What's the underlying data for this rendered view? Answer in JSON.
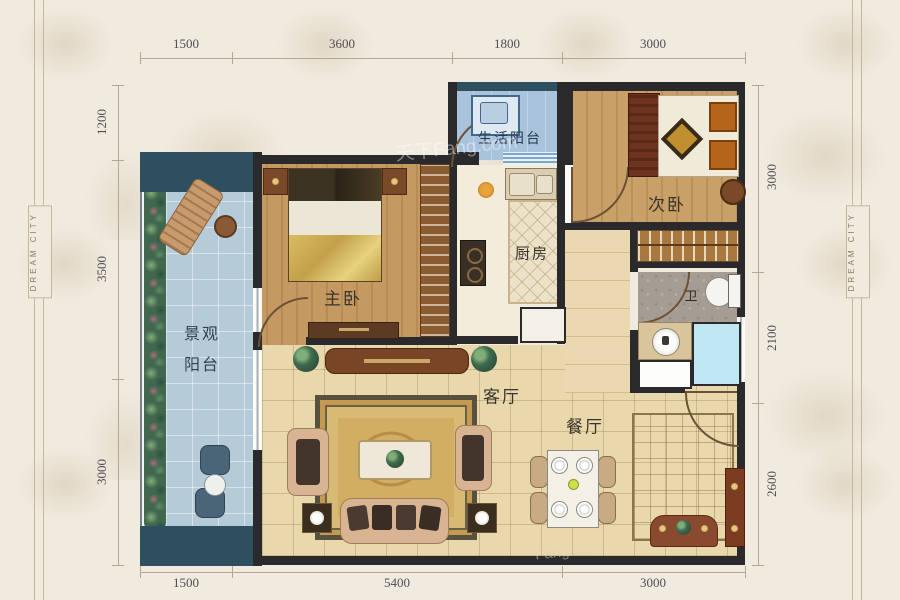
{
  "page": {
    "brand_left": "DREAM CITY",
    "brand_right": "DREAM CITY",
    "watermark_top": "天下Fang.com",
    "watermark_bottom": "Fang.com"
  },
  "dimensions": {
    "top": [
      "1500",
      "3600",
      "1800",
      "3000"
    ],
    "bottom": [
      "1500",
      "5400",
      "3000"
    ],
    "left": [
      "1200",
      "3500",
      "3000"
    ],
    "right": [
      "3000",
      "2100",
      "2600"
    ]
  },
  "rooms": {
    "view_balcony_line1": "景观",
    "view_balcony_line2": "阳台",
    "master_bedroom": "主卧",
    "life_balcony": "生活阳台",
    "kitchen": "厨房",
    "second_bedroom": "次卧",
    "bathroom": "卫",
    "living_room": "客厅",
    "dining_room": "餐厅"
  }
}
